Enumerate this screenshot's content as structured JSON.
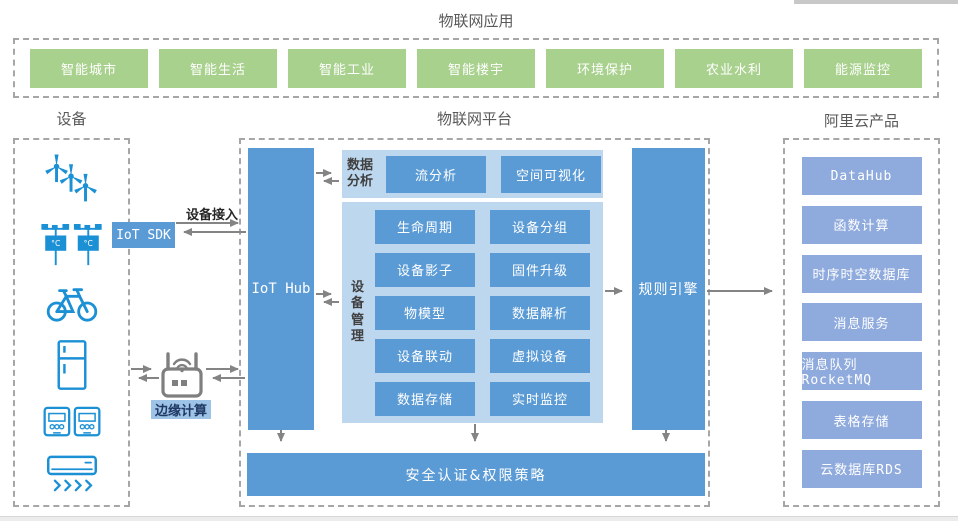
{
  "top_apps": {
    "title": "物联网应用",
    "items": [
      "智能城市",
      "智能生活",
      "智能工业",
      "智能楼宇",
      "环境保护",
      "农业水利",
      "能源监控"
    ]
  },
  "devices": {
    "title": "设备",
    "temp_unit": "°C",
    "icons": [
      {
        "name": "wind-turbine-icon"
      },
      {
        "name": "weather-station-icon"
      },
      {
        "name": "bicycle-icon"
      },
      {
        "name": "refrigerator-icon"
      },
      {
        "name": "electric-meter-icon"
      },
      {
        "name": "air-conditioner-icon"
      }
    ]
  },
  "connections": {
    "sdk_label": "IoT SDK",
    "access_label": "设备接入",
    "edge_label": "边缘计算",
    "router_icon": "wifi-router-icon"
  },
  "platform": {
    "title": "物联网平台",
    "hub_label": "IoT Hub",
    "data_analysis": {
      "label": "数据分析",
      "buttons": [
        "流分析",
        "空间可视化"
      ]
    },
    "device_mgmt": {
      "label": "设备管理",
      "buttons_left": [
        "生命周期",
        "设备影子",
        "物模型",
        "设备联动",
        "数据存储"
      ],
      "buttons_right": [
        "设备分组",
        "固件升级",
        "数据解析",
        "虚拟设备",
        "实时监控"
      ]
    },
    "rule_engine_label": "规则引擎",
    "security_label": "安全认证&权限策略"
  },
  "cloud": {
    "title": "阿里云产品",
    "items": [
      "DataHub",
      "函数计算",
      "时序时空数据库",
      "消息服务",
      "消息队列RocketMQ",
      "表格存储",
      "云数据库RDS"
    ]
  },
  "colors": {
    "primary_blue": "#5b9bd5",
    "panel_blue": "#bdd7ee",
    "product_blue": "#8faadc",
    "app_green": "#a9d18e",
    "edge_label_bg": "#9dc3e6",
    "device_icon_blue": "#1b90d5",
    "arrow_gray": "#848484",
    "dashed_border_gray": "#a6a6a6"
  }
}
